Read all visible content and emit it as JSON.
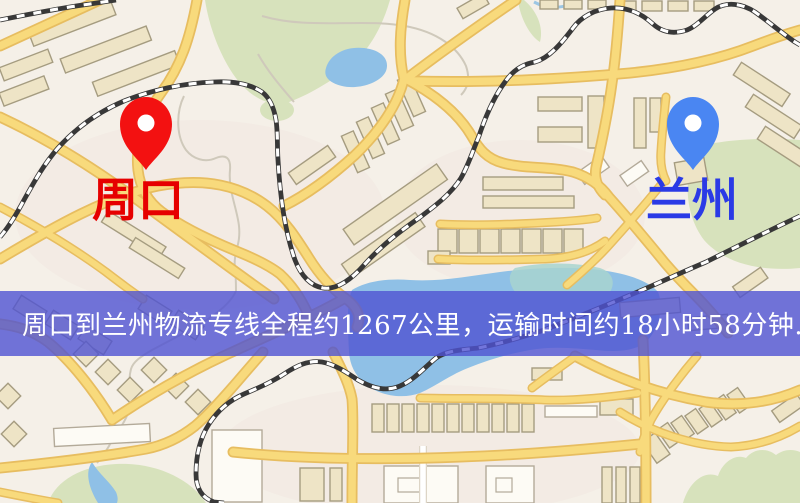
{
  "map": {
    "origin": {
      "label": "周口",
      "icon": "map-pin-icon"
    },
    "destination": {
      "label": "兰州",
      "icon": "map-pin-icon"
    }
  },
  "banner": {
    "text": "周口到兰州物流专线全程约1267公里，运输时间约18小时58分钟."
  },
  "colors": {
    "map-bg": "#f5f0e8",
    "park": "#d7e2bc",
    "water": "#8fc0e6",
    "road-fill": "#f8da7c",
    "road-casing": "#e7bd60",
    "building": "#eee4c6",
    "building-outline": "#a59c80",
    "building-white": "#fdfbf5",
    "rail-dark": "#383838",
    "rail-light": "#ffffff",
    "stream": "#cfc9bb",
    "banner-bg": "rgba(79,83,210,0.8)",
    "banner-text": "#ffffff",
    "origin-text": "#e60000",
    "destination-text": "#2a3ae6",
    "origin-pin": "#f31111",
    "destination-pin": "#4a86f2"
  }
}
